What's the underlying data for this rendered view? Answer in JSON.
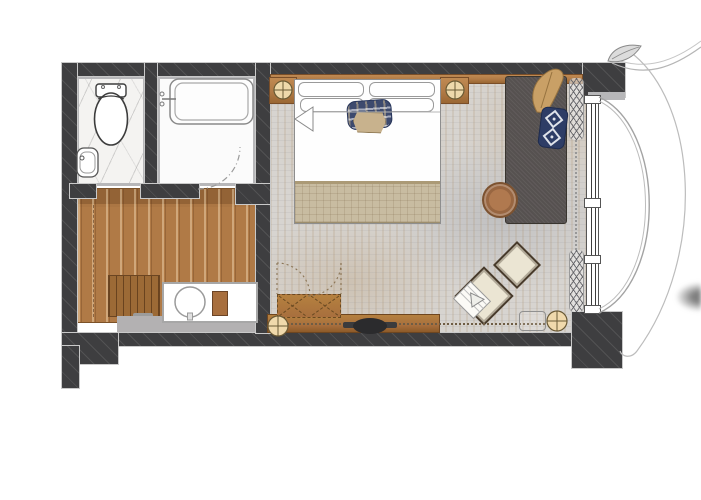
{
  "meta": {
    "kind": "architectural floor plan",
    "subject": "hotel guest room plan with bathroom, dressing area, bedroom and curved balcony",
    "visible_text": ""
  },
  "colors": {
    "wall": "#3e3e40",
    "wall_edge": "#c9c9c9",
    "lining": "#b7b7b9",
    "marble": "#f4f3f1",
    "tub_floor": "#fbfbfb",
    "wood": "#b07a46",
    "mat": "#9c6a36",
    "gray_floor": "#b3b1b2",
    "rug": "#d7d4d0",
    "navy": "#3d4a6e",
    "tan_pillow": "#c8b28d",
    "blanket": "#c8bca1",
    "sofa": "#565150",
    "throw": "#c9a066",
    "cream": "#ebe5d3",
    "cream_border": "#473a2b",
    "lamp": "#f0d9ac",
    "lamp_border": "#6a5a36",
    "table_wood": "#b0794f",
    "console": "#a86f3e",
    "tv": "#2d2d2f",
    "line": "#8f8f8f",
    "curve": "#b5b5b5",
    "bar": "#7f7f7f"
  },
  "rooms": [
    {
      "name": "bathroom-wc"
    },
    {
      "name": "bathroom-tub"
    },
    {
      "name": "dressing-area"
    },
    {
      "name": "bedroom"
    },
    {
      "name": "balcony"
    }
  ],
  "furniture": [
    "toilet",
    "hand-basin",
    "bathtub",
    "tub-door-swing",
    "vanity-basin",
    "vanity-stool",
    "entry-mat",
    "wardrobe",
    "wardrobe-door-swing",
    "tv-console",
    "tv",
    "floor-lamp",
    "bed",
    "pillows",
    "plaid-pillow",
    "tan-pillow",
    "duvet-fold",
    "foot-blanket",
    "nightstand",
    "table-lamp",
    "sofa",
    "throw-blanket",
    "ikat-pillow",
    "coffee-table",
    "ottoman",
    "folded-towel",
    "side-table",
    "curtain",
    "window",
    "balcony-arc",
    "facade-curve",
    "leaf-ornament"
  ]
}
